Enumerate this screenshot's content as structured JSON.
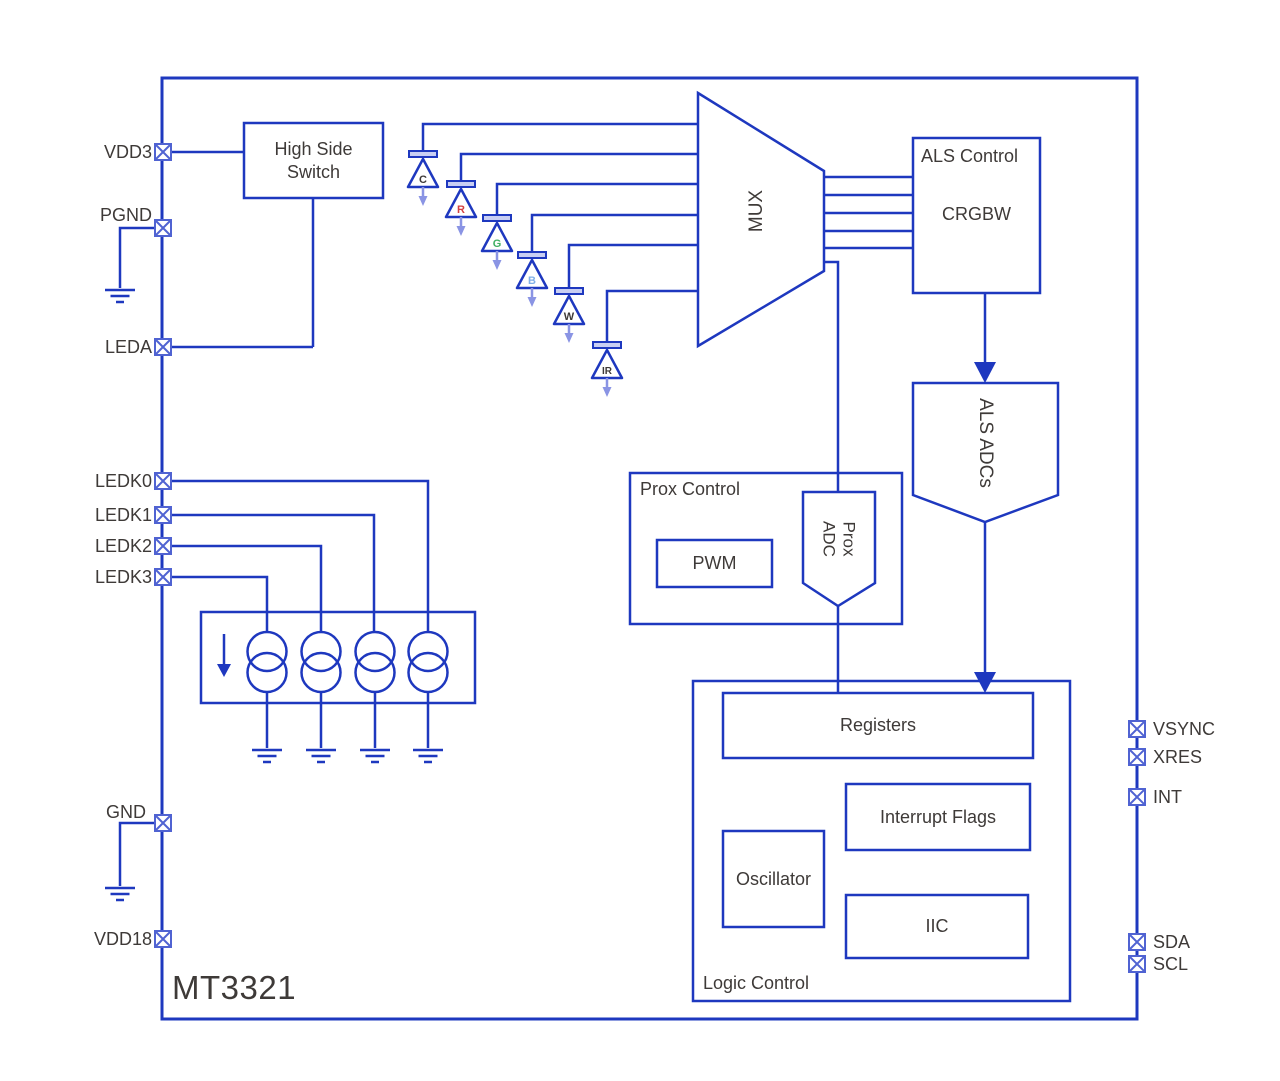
{
  "chip": {
    "name": "MT3321"
  },
  "colors": {
    "line": "#1e38bf",
    "pin_box": "#5063d2",
    "light_accent": "#8a94e4",
    "label_text": "#3e3a38",
    "diode_bar_fill": "#c9cff3",
    "background": "#ffffff"
  },
  "icons": {
    "pin": "x-box-pad-icon",
    "ground": "earth-ground-icon",
    "current_source": "current-source-icon",
    "arrow": "down-arrow-icon",
    "photodiode": "photodiode-icon"
  },
  "pins": {
    "left": [
      {
        "label": "VDD3"
      },
      {
        "label": "PGND"
      },
      {
        "label": "LEDA"
      },
      {
        "label": "LEDK0"
      },
      {
        "label": "LEDK1"
      },
      {
        "label": "LEDK2"
      },
      {
        "label": "LEDK3"
      },
      {
        "label": "GND"
      },
      {
        "label": "VDD18"
      }
    ],
    "right": [
      {
        "label": "VSYNC"
      },
      {
        "label": "XRES"
      },
      {
        "label": "INT"
      },
      {
        "label": "SDA"
      },
      {
        "label": "SCL"
      }
    ]
  },
  "blocks": {
    "high_side_switch": "High Side Switch",
    "mux": "MUX",
    "als_control_title": "ALS Control",
    "als_control_sub": "CRGBW",
    "als_adcs": "ALS ADCs",
    "prox_control": "Prox Control",
    "pwm": "PWM",
    "prox_adc": "Prox ADC",
    "logic_control": "Logic Control",
    "registers": "Registers",
    "interrupt_flags": "Interrupt Flags",
    "oscillator": "Oscillator",
    "iic": "IIC"
  },
  "photodiodes": [
    {
      "label": "C",
      "color": "#3e3a38"
    },
    {
      "label": "R",
      "color": "#d34040"
    },
    {
      "label": "G",
      "color": "#3fae62"
    },
    {
      "label": "B",
      "color": "#80b0e8"
    },
    {
      "label": "W",
      "color": "#3e3a38"
    },
    {
      "label": "IR",
      "color": "#3e3a38"
    }
  ]
}
